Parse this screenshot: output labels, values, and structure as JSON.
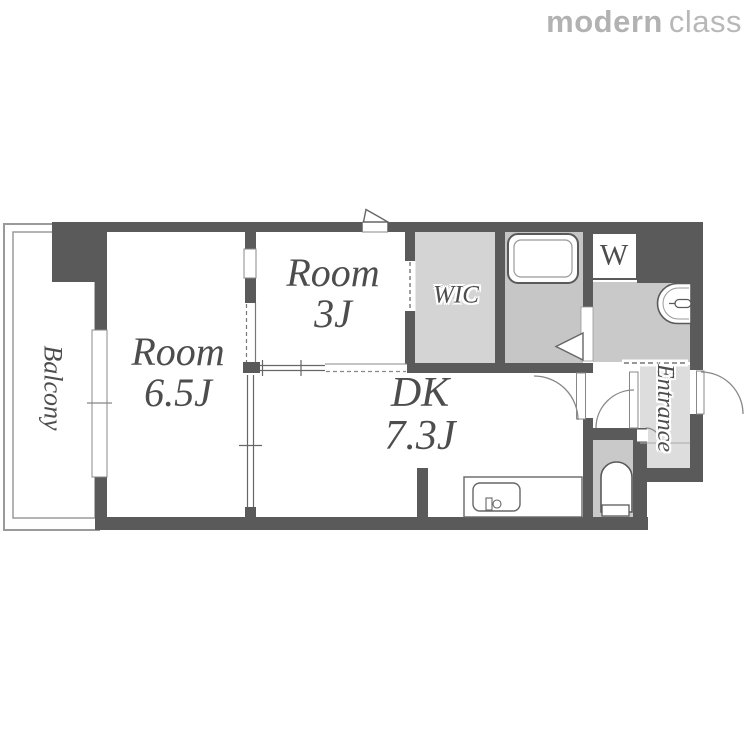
{
  "logo": {
    "bold": "modern",
    "light": "class"
  },
  "rooms": {
    "balcony": {
      "label": "Balcony"
    },
    "room65": {
      "line1": "Room",
      "line2": "6.5J"
    },
    "room3": {
      "line1": "Room",
      "line2": "3J"
    },
    "dk": {
      "line1": "DK",
      "line2": "7.3J"
    },
    "wic": {
      "label": "WIC"
    },
    "washer": {
      "label": "W"
    },
    "entrance": {
      "label": "Entrance"
    }
  },
  "colors": {
    "wall": "#5a5a5a",
    "wic_floor": "#d4d4d4",
    "bath_floor": "#c6c6c6",
    "wash_floor": "#c9c9c9",
    "toilet_floor": "#c9c9c9",
    "entrance_floor": "#dddddd",
    "label_text": "#4d4d4d",
    "logo_color": "#b2b2b2"
  }
}
